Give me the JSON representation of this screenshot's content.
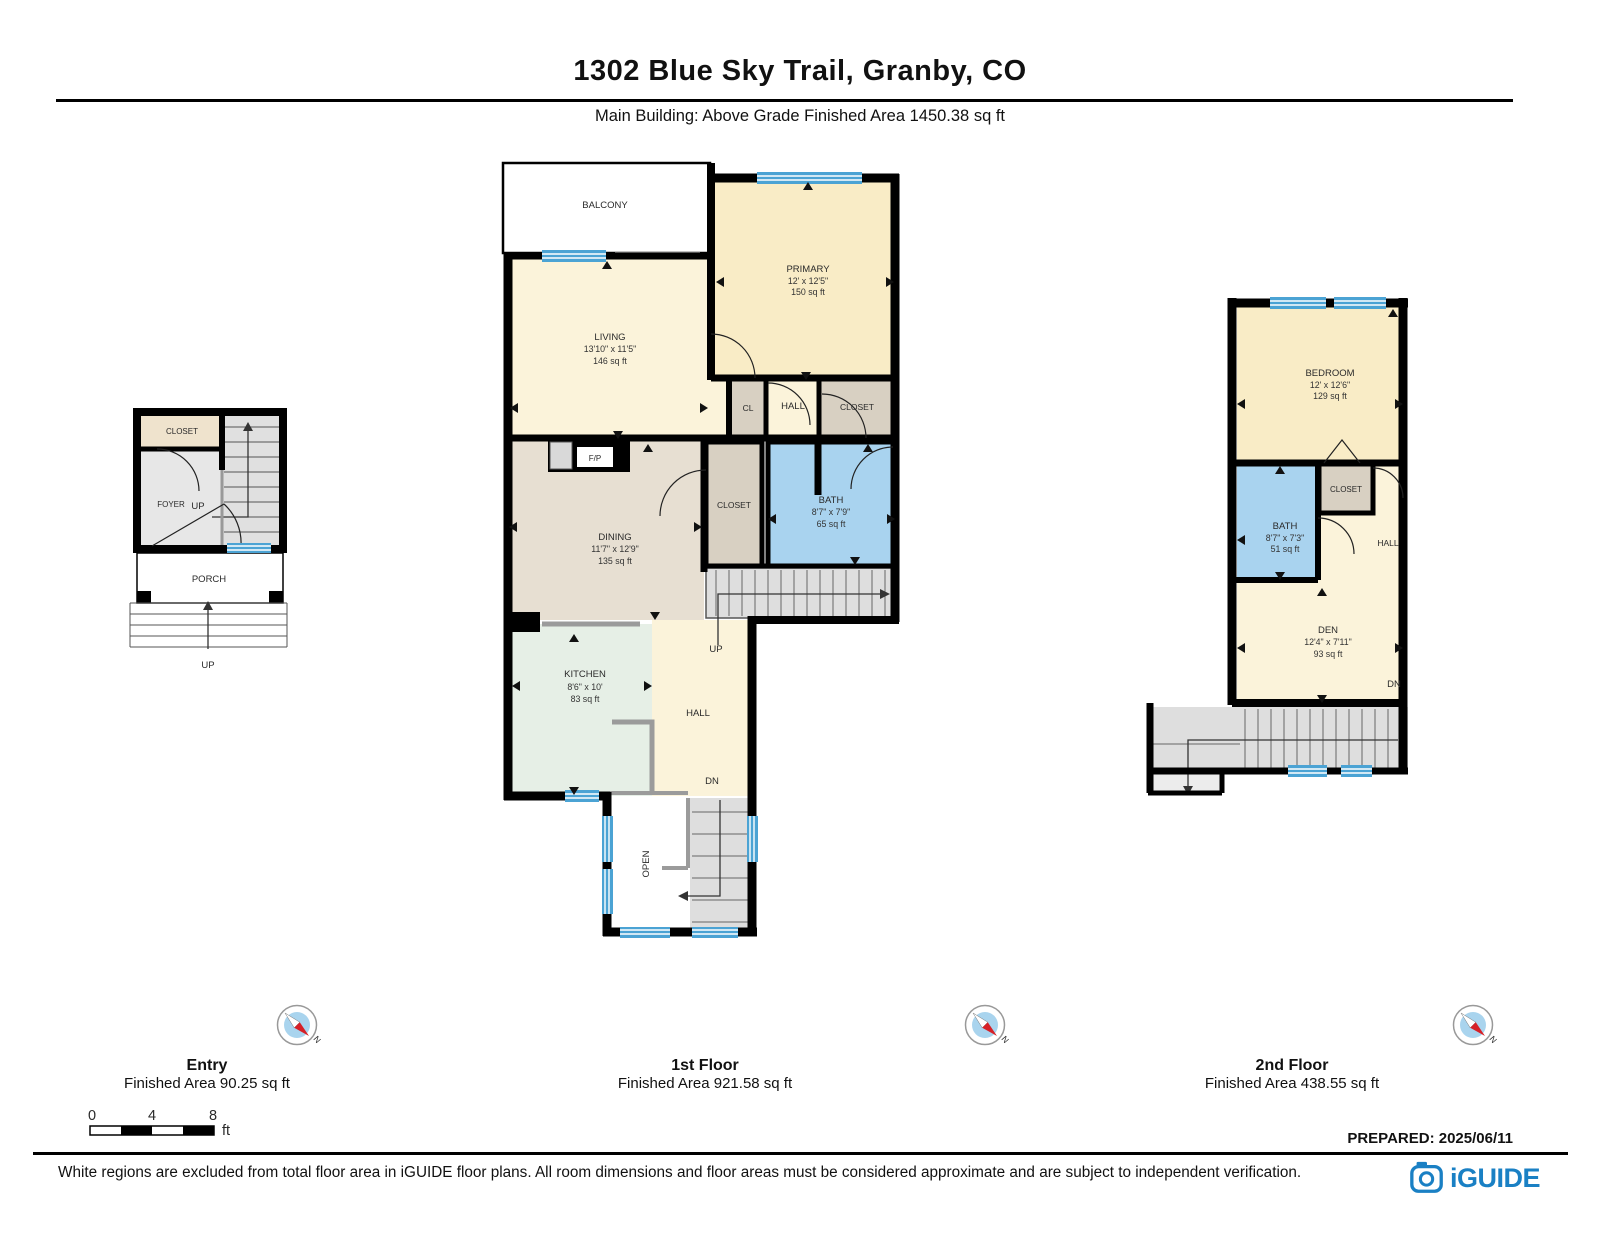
{
  "header": {
    "title": "1302 Blue Sky Trail, Granby, CO",
    "subtitle": "Main Building: Above Grade Finished Area 1450.38 sq ft"
  },
  "footer": {
    "prepared": "PREPARED: 2025/06/11",
    "disclaimer": "White regions are excluded from total floor area in iGUIDE floor plans. All room dimensions and floor areas must be considered approximate and are subject to independent verification.",
    "brand": "iGUIDE"
  },
  "scale": {
    "t0": "0",
    "t4": "4",
    "t8": "8",
    "unit": "ft"
  },
  "compass": {
    "label": "N"
  },
  "floors": [
    {
      "name": "Entry",
      "area": "Finished Area 90.25 sq ft"
    },
    {
      "name": "1st Floor",
      "area": "Finished Area 921.58 sq ft"
    },
    {
      "name": "2nd Floor",
      "area": "Finished Area 438.55 sq ft"
    }
  ],
  "entry": {
    "closet": "CLOSET",
    "foyer": "FOYER",
    "up_stairs": "UP",
    "porch": "PORCH",
    "up_steps": "UP"
  },
  "floor1": {
    "balcony": "BALCONY",
    "primary": {
      "name": "PRIMARY",
      "dims": "12' x 12'5\"",
      "area": "150 sq ft"
    },
    "living": {
      "name": "LIVING",
      "dims": "13'10\" x 11'5\"",
      "area": "146 sq ft"
    },
    "cl": "CL",
    "hall_top": "HALL",
    "closet_top": "CLOSET",
    "fireplace": "F/P",
    "dining": {
      "name": "DINING",
      "dims": "11'7\" x 12'9\"",
      "area": "135 sq ft"
    },
    "closet_mid": "CLOSET",
    "bath": {
      "name": "BATH",
      "dims": "8'7\" x 7'9\"",
      "area": "65 sq ft"
    },
    "up": "UP",
    "kitchen": {
      "name": "KITCHEN",
      "dims": "8'6\" x 10'",
      "area": "83 sq ft"
    },
    "hall_bottom": "HALL",
    "dn": "DN",
    "open": "OPEN"
  },
  "floor2": {
    "bedroom": {
      "name": "BEDROOM",
      "dims": "12' x 12'6\"",
      "area": "129 sq ft"
    },
    "closet": "CLOSET",
    "bath": {
      "name": "BATH",
      "dims": "8'7\" x 7'3\"",
      "area": "51 sq ft"
    },
    "hall": "HALL",
    "den": {
      "name": "DEN",
      "dims": "12'4\" x 7'11\"",
      "area": "93 sq ft"
    },
    "dn": "DN"
  },
  "colors": {
    "wall": "#000000",
    "window": "#4ba3d4",
    "room_tan": "#f9ecc6",
    "room_cream": "#fbf3da",
    "room_beige": "#e7dfd2",
    "room_green": "#e6efe6",
    "room_blue": "#a9d3ef",
    "closet_taupe": "#d8d0c2",
    "stairs_gray": "#dedede",
    "brand_blue": "#1a80c4",
    "compass_blue": "#a9d4ee",
    "compass_red": "#d62027"
  }
}
